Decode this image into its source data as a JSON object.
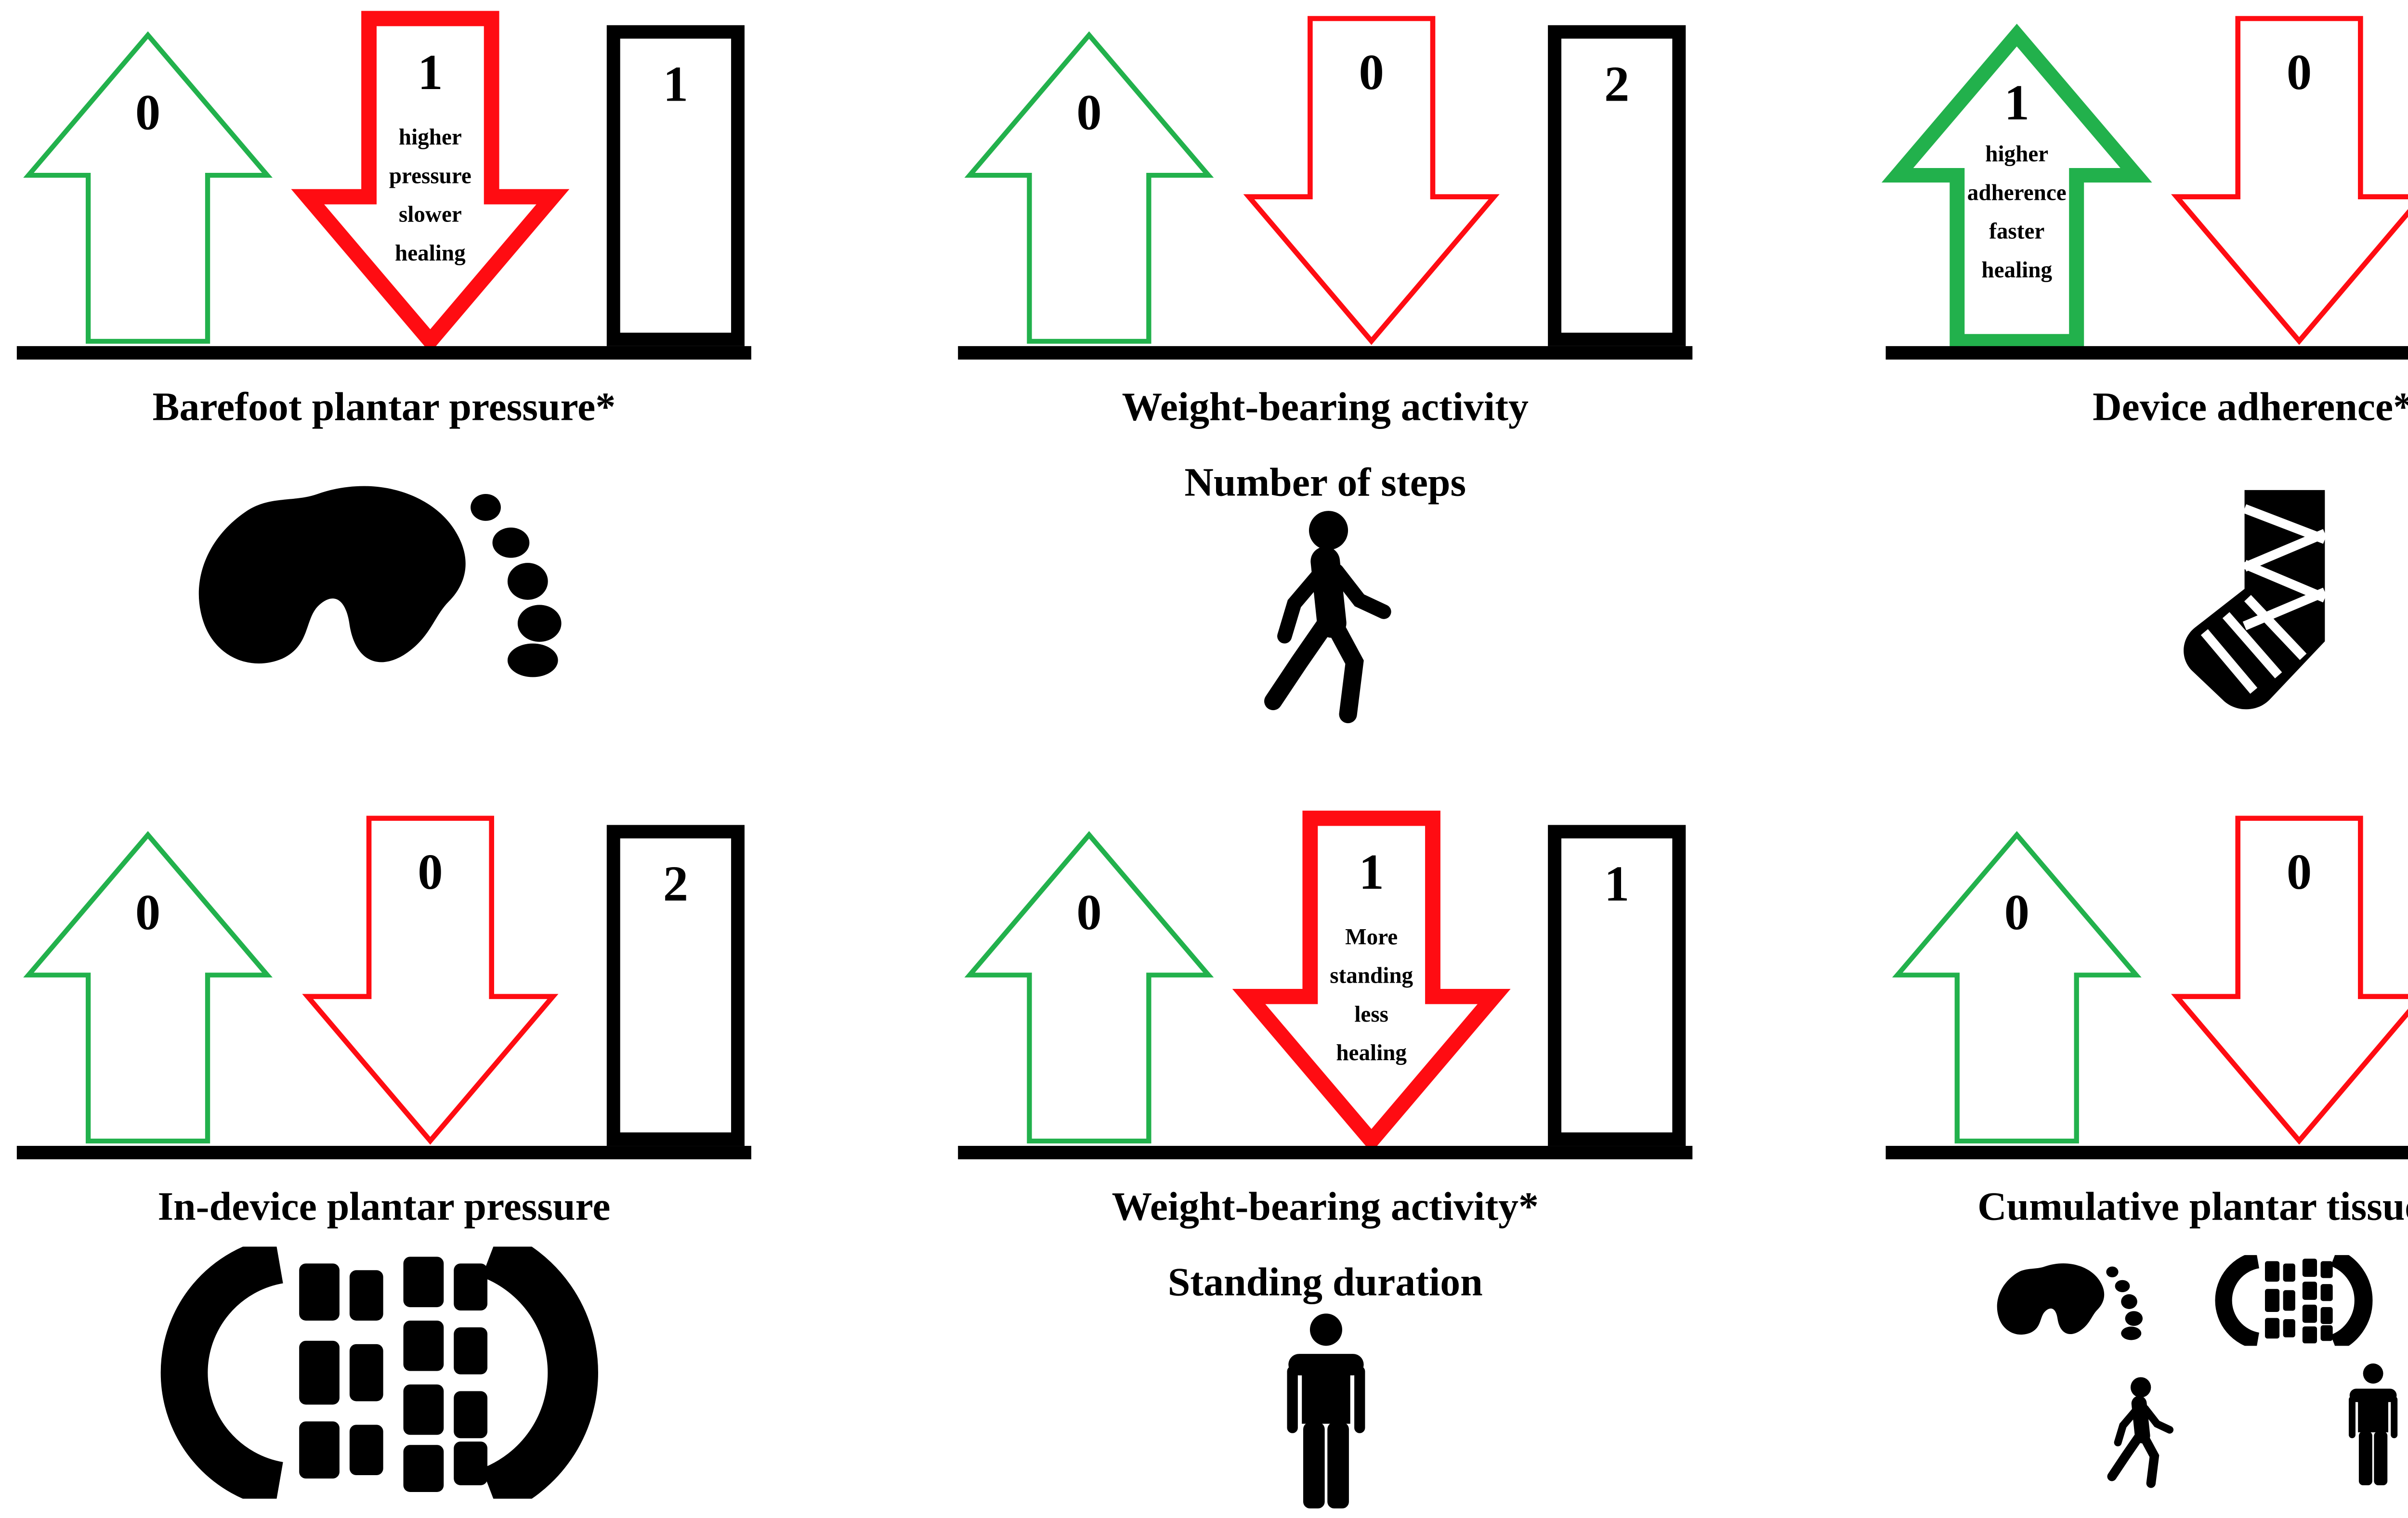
{
  "colors": {
    "positive_green": "#22B14C",
    "negative_red": "#FF0C12",
    "neutral_black": "#000000"
  },
  "panels": [
    {
      "id": "barefoot-plantar-pressure",
      "caption": [
        "Barefoot plantar pressure*"
      ],
      "up": {
        "value": "0",
        "emphasized": false
      },
      "down": {
        "value": "1",
        "emphasized": true,
        "note": [
          "higher",
          "pressure",
          "slower",
          "healing"
        ]
      },
      "box": {
        "value": "1"
      },
      "icons": [
        "barefoot-print"
      ]
    },
    {
      "id": "weight-bearing-activity-number-of-steps",
      "caption": [
        "Weight-bearing activity",
        "Number of steps"
      ],
      "up": {
        "value": "0",
        "emphasized": false
      },
      "down": {
        "value": "0",
        "emphasized": false
      },
      "box": {
        "value": "2"
      },
      "icons": [
        "walking-person"
      ]
    },
    {
      "id": "device-adherence",
      "caption": [
        "Device adherence*"
      ],
      "up": {
        "value": "1",
        "emphasized": true,
        "note": [
          "higher",
          "adherence",
          "faster",
          "healing"
        ]
      },
      "down": {
        "value": "0",
        "emphasized": false
      },
      "box": {
        "value": "1"
      },
      "icons": [
        "bandaged-foot-cast"
      ]
    },
    {
      "id": "in-device-plantar-pressure",
      "caption": [
        "In-device plantar pressure"
      ],
      "up": {
        "value": "0",
        "emphasized": false
      },
      "down": {
        "value": "0",
        "emphasized": false
      },
      "box": {
        "value": "2"
      },
      "icons": [
        "shoe-print"
      ]
    },
    {
      "id": "weight-bearing-activity-standing-duration",
      "caption": [
        "Weight-bearing activity*",
        "Standing duration"
      ],
      "up": {
        "value": "0",
        "emphasized": false
      },
      "down": {
        "value": "1",
        "emphasized": true,
        "note": [
          "More",
          "standing",
          "less",
          "healing"
        ]
      },
      "box": {
        "value": "1"
      },
      "icons": [
        "standing-person"
      ]
    },
    {
      "id": "cumulative-plantar-tissue-stress",
      "caption": [
        "Cumulative plantar tissue stress"
      ],
      "up": {
        "value": "0",
        "emphasized": false
      },
      "down": {
        "value": "0",
        "emphasized": false
      },
      "box": {
        "value": "1"
      },
      "icons": [
        "barefoot-print",
        "shoe-print",
        "bandaged-foot-cast",
        "walking-person",
        "standing-person"
      ]
    }
  ]
}
